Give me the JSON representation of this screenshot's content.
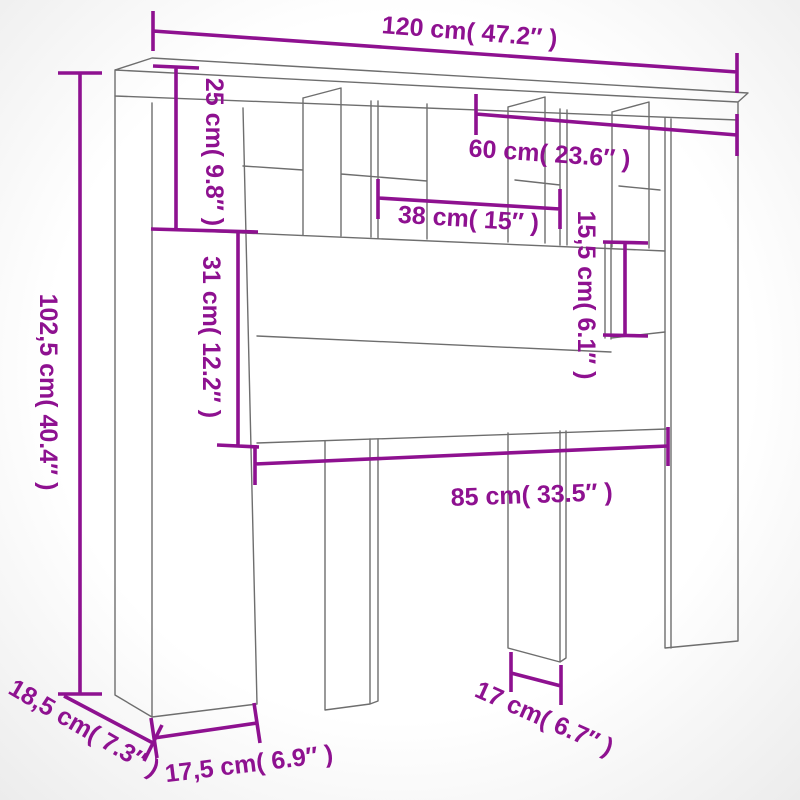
{
  "title": "Headboard cabinet with storage - dimension diagram",
  "colors": {
    "background": "#ffffff",
    "outline": "#6e6e6e",
    "dimension": "#8e1190"
  },
  "units": {
    "metric": "cm",
    "imperial": "inch"
  },
  "labels": {
    "top_width": "120 cm( 47.2″ )",
    "upper_row_height": "25 cm( 9.8″ )",
    "right_section_width": "60 cm( 23.6″ )",
    "middle_cubby_width": "38 cm( 15″ )",
    "right_shelf_height": "15,5 cm( 6.1″ )",
    "panel_height": "31 cm( 12.2″ )",
    "total_height": "102,5 cm( 40.4″ )",
    "lower_width": "85 cm( 33.5″ )",
    "side_foot_depth": "18,5 cm( 7.3″ )",
    "front_foot_width": "17,5 cm( 6.9″ )",
    "middle_leg_width": "17 cm( 6.7″ )"
  }
}
